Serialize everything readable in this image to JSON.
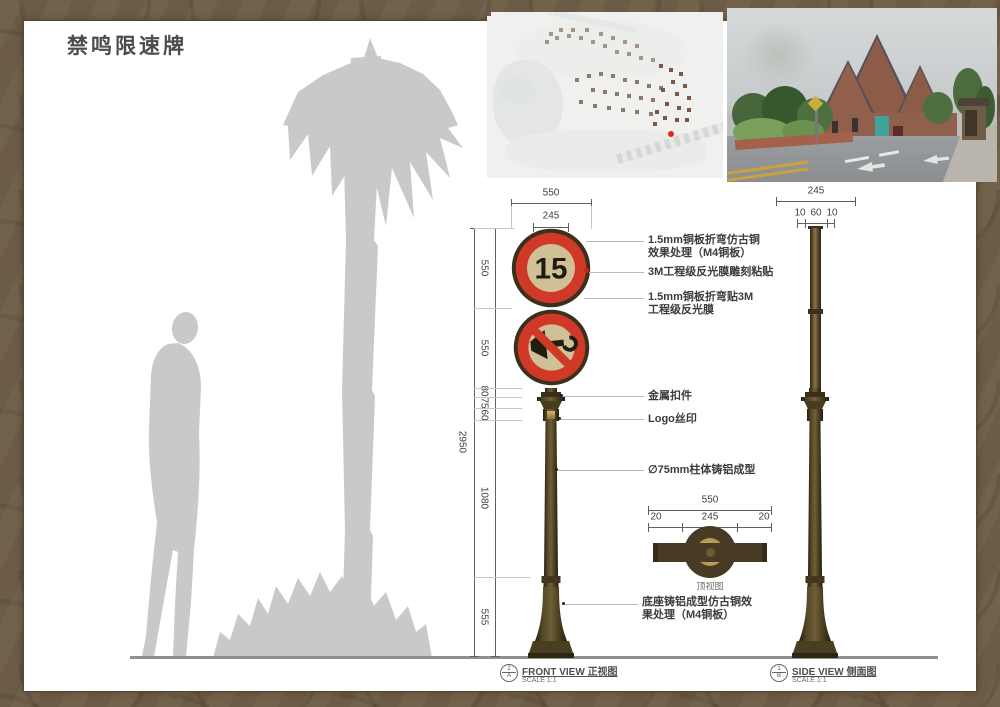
{
  "title": "禁鸣限速牌",
  "front_view": {
    "sign_speed": "15",
    "dim_top_outer": "550",
    "dim_top_inner": "245",
    "dim_total": "2950",
    "seg1": "550",
    "seg2": "550",
    "seg3": "80",
    "seg4": "75",
    "seg5": "60",
    "seg6": "1080",
    "seg7": "555",
    "marker_num": "2",
    "marker_letter": "A",
    "label_en": "FRONT VIEW",
    "label_zh": "正视图",
    "scale": "SCALE 1:1"
  },
  "side_view": {
    "dim_top": "245",
    "sub_left": "10",
    "sub_mid": "60",
    "sub_right": "10",
    "marker_num": "1",
    "marker_letter": "B",
    "label_en": "SIDE VIEW",
    "label_zh": "侧面图",
    "scale": "SCALE 1:1"
  },
  "top_view": {
    "dim_outer": "550",
    "dim_left": "20",
    "dim_mid": "245",
    "dim_right": "20",
    "label": "顶视图"
  },
  "annotations": {
    "a1": "1.5mm铜板折弯仿古铜\n效果处理（M4铜板）",
    "a2": "3M工程级反光膜雕刻粘贴",
    "a3": "1.5mm铜板折弯贴3M\n工程级反光膜",
    "a4": "金属扣件",
    "a5": "Logo丝印",
    "a6": "∅75mm柱体铸铝成型",
    "a7": "底座铸铝成型仿古铜效\n果处理（M4铜板）"
  },
  "colors": {
    "sign_red": "#d03928",
    "sign_panel_tan": "#cfc096",
    "ring_dark": "#3a301c",
    "pole_brown": "#5a4a2e",
    "gold": "#c2a256",
    "silhouette_gray": "#c9c9c9",
    "frame_brown": "#6f5e48",
    "location_dot_red": "#e02818"
  }
}
